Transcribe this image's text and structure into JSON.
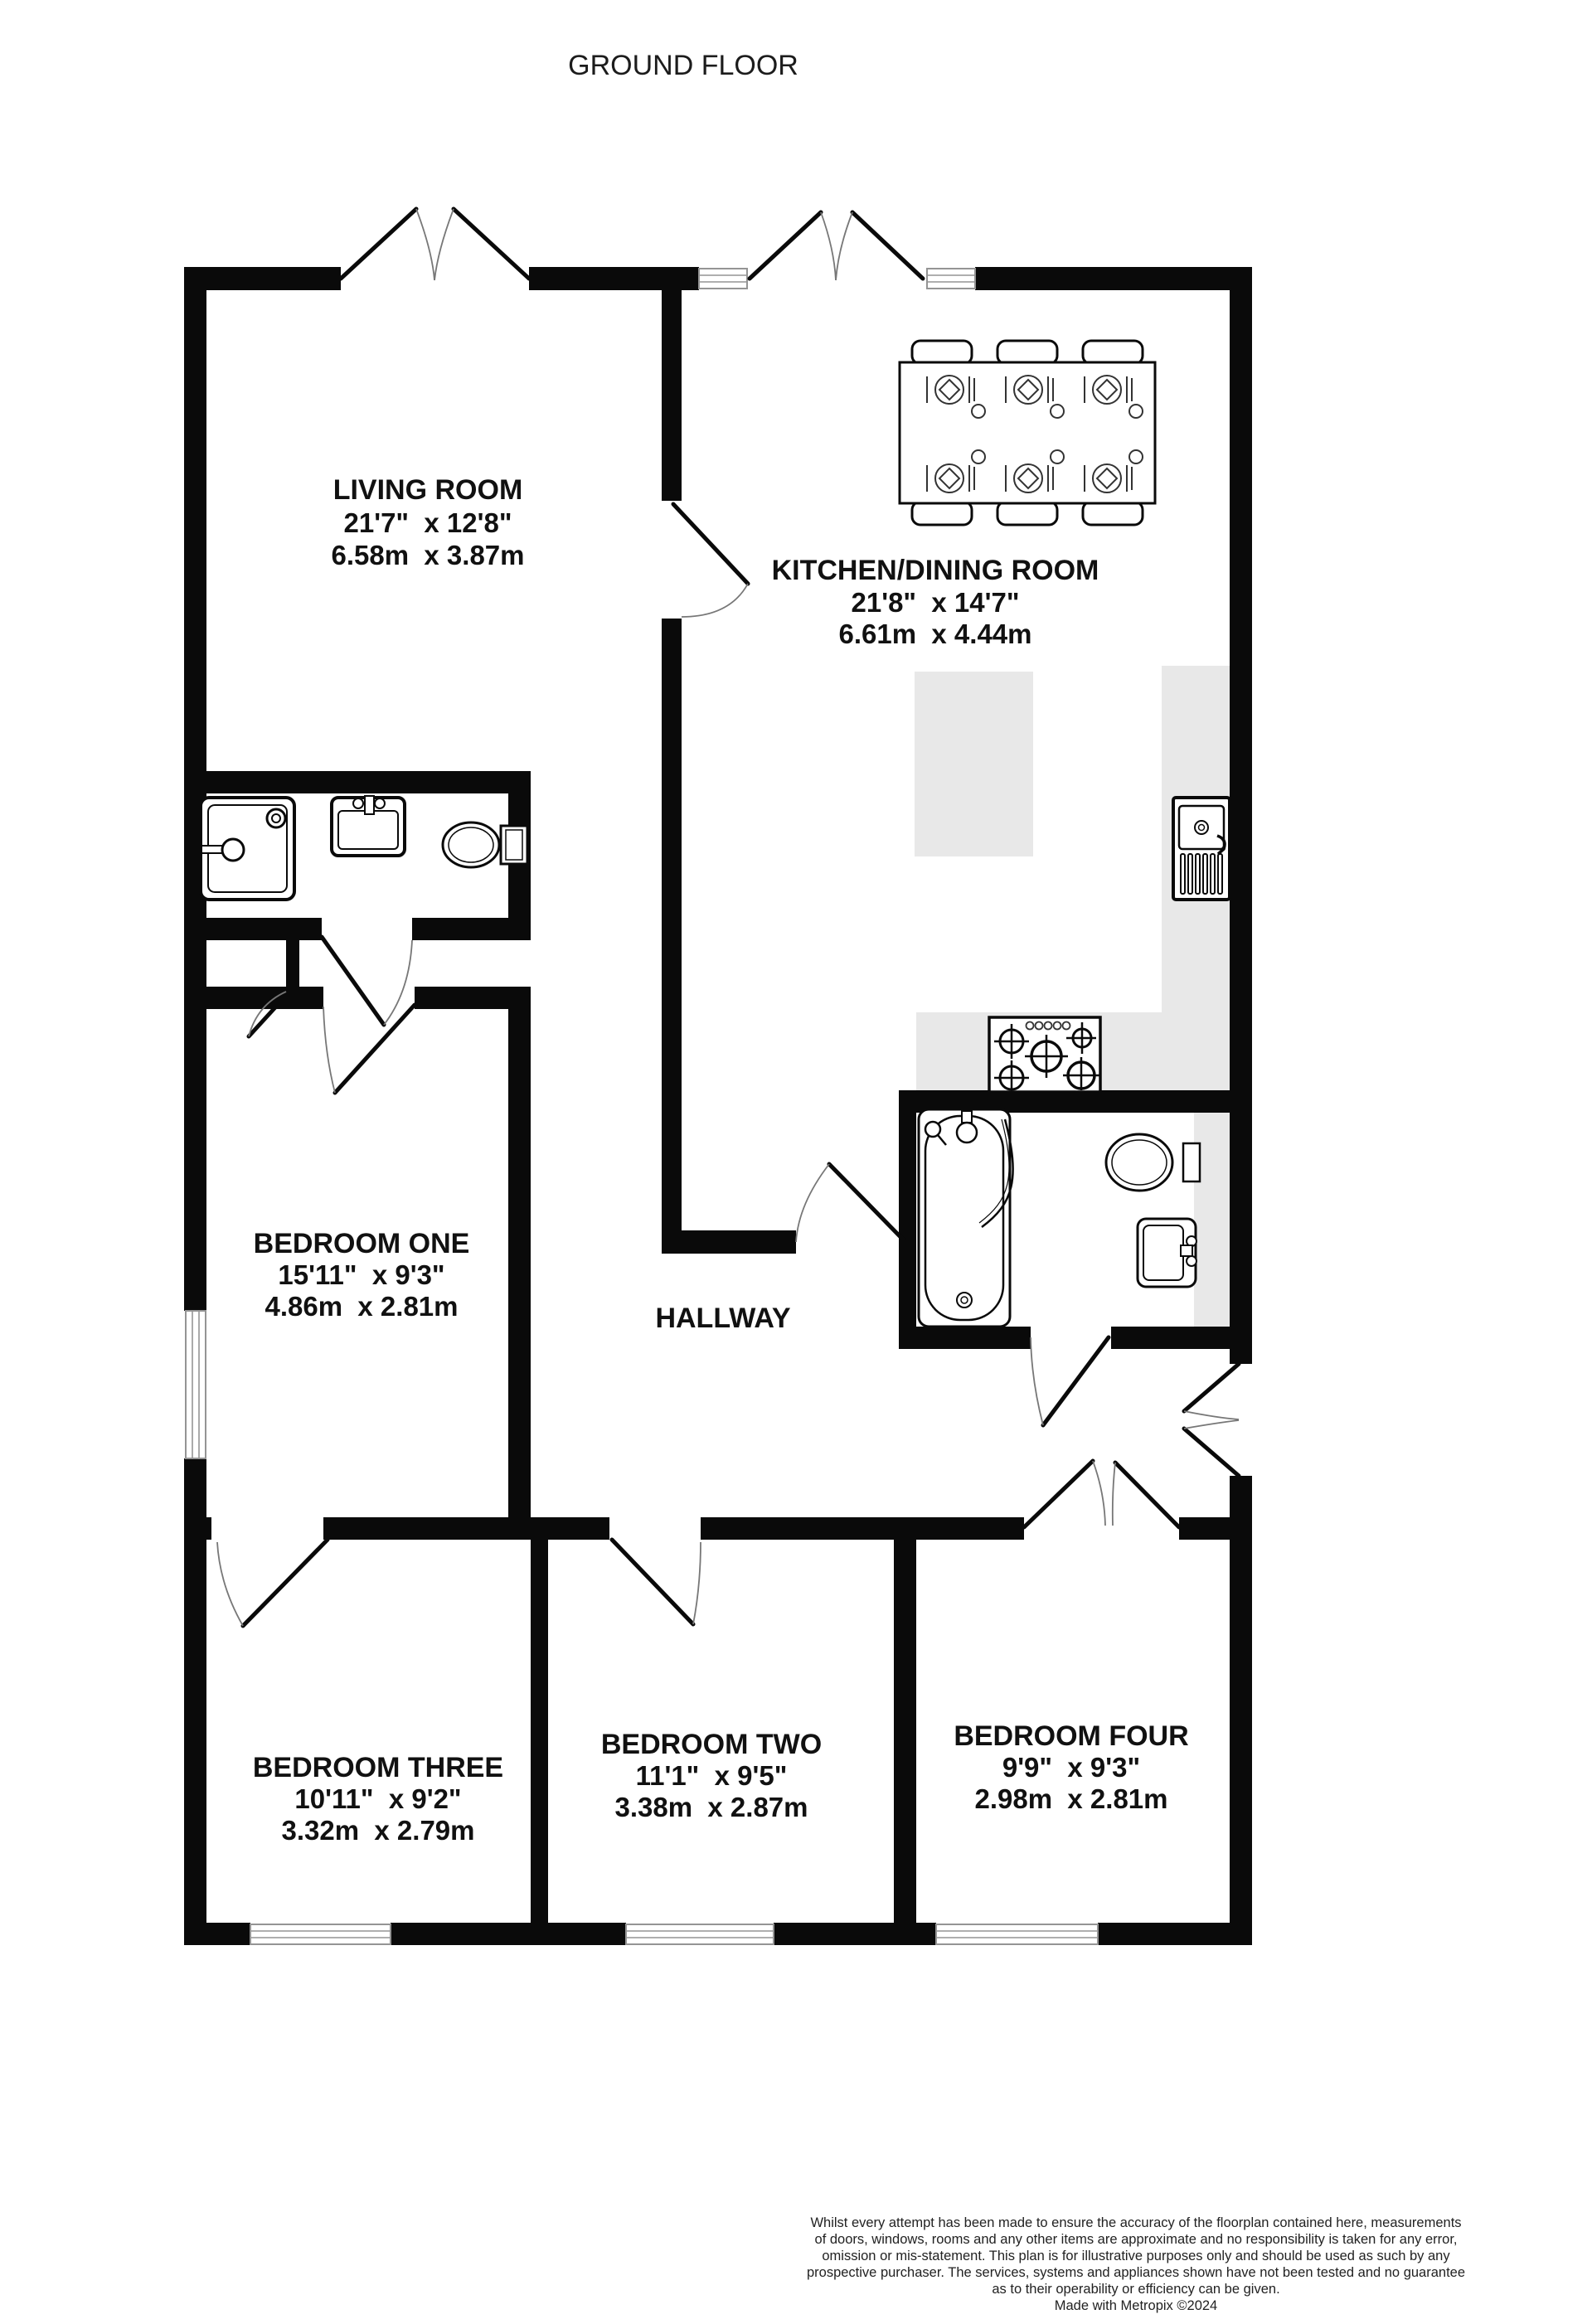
{
  "floor_label": "GROUND FLOOR",
  "rooms": {
    "living": {
      "name": "LIVING ROOM",
      "imperial": "21'7\"  x 12'8\"",
      "metric": "6.58m  x 3.87m"
    },
    "kitchen": {
      "name": "KITCHEN/DINING ROOM",
      "imperial": "21'8\"  x 14'7\"",
      "metric": "6.61m  x 4.44m"
    },
    "bedroom_one": {
      "name": "BEDROOM ONE",
      "imperial": "15'11\"  x 9'3\"",
      "metric": "4.86m  x 2.81m"
    },
    "hallway": {
      "name": "HALLWAY"
    },
    "bedroom_three": {
      "name": "BEDROOM THREE",
      "imperial": "10'11\"  x 9'2\"",
      "metric": "3.32m  x 2.79m"
    },
    "bedroom_two": {
      "name": "BEDROOM TWO",
      "imperial": "11'1\"  x 9'5\"",
      "metric": "3.38m  x 2.87m"
    },
    "bedroom_four": {
      "name": "BEDROOM FOUR",
      "imperial": "9'9\"  x 9'3\"",
      "metric": "2.98m  x 2.81m"
    }
  },
  "fixtures": [
    "shower",
    "washbasin",
    "toilet",
    "dining-table",
    "chairs",
    "place-settings",
    "kitchen-island",
    "worktop",
    "sink-with-drainer",
    "gas-hob",
    "bathtub",
    "bathroom-toilet",
    "bathroom-basin"
  ],
  "colors": {
    "wall": "#0a0a0a",
    "worktop": "#e8e8e8",
    "window_frame": "#949494",
    "door_arc": "#777777",
    "text": "#111111"
  },
  "disclaimer": {
    "lines": [
      "Whilst every attempt has been made to ensure the accuracy of the floorplan contained here, measurements",
      "of doors, windows, rooms and any other items are approximate and no responsibility is taken for any error,",
      "omission or mis-statement. This plan is for illustrative purposes only and should be used as such by any",
      "prospective purchaser. The services, systems and appliances shown have not been tested and no guarantee",
      "as to their operability or efficiency can be given."
    ],
    "credit": "Made with Metropix ©2024"
  }
}
